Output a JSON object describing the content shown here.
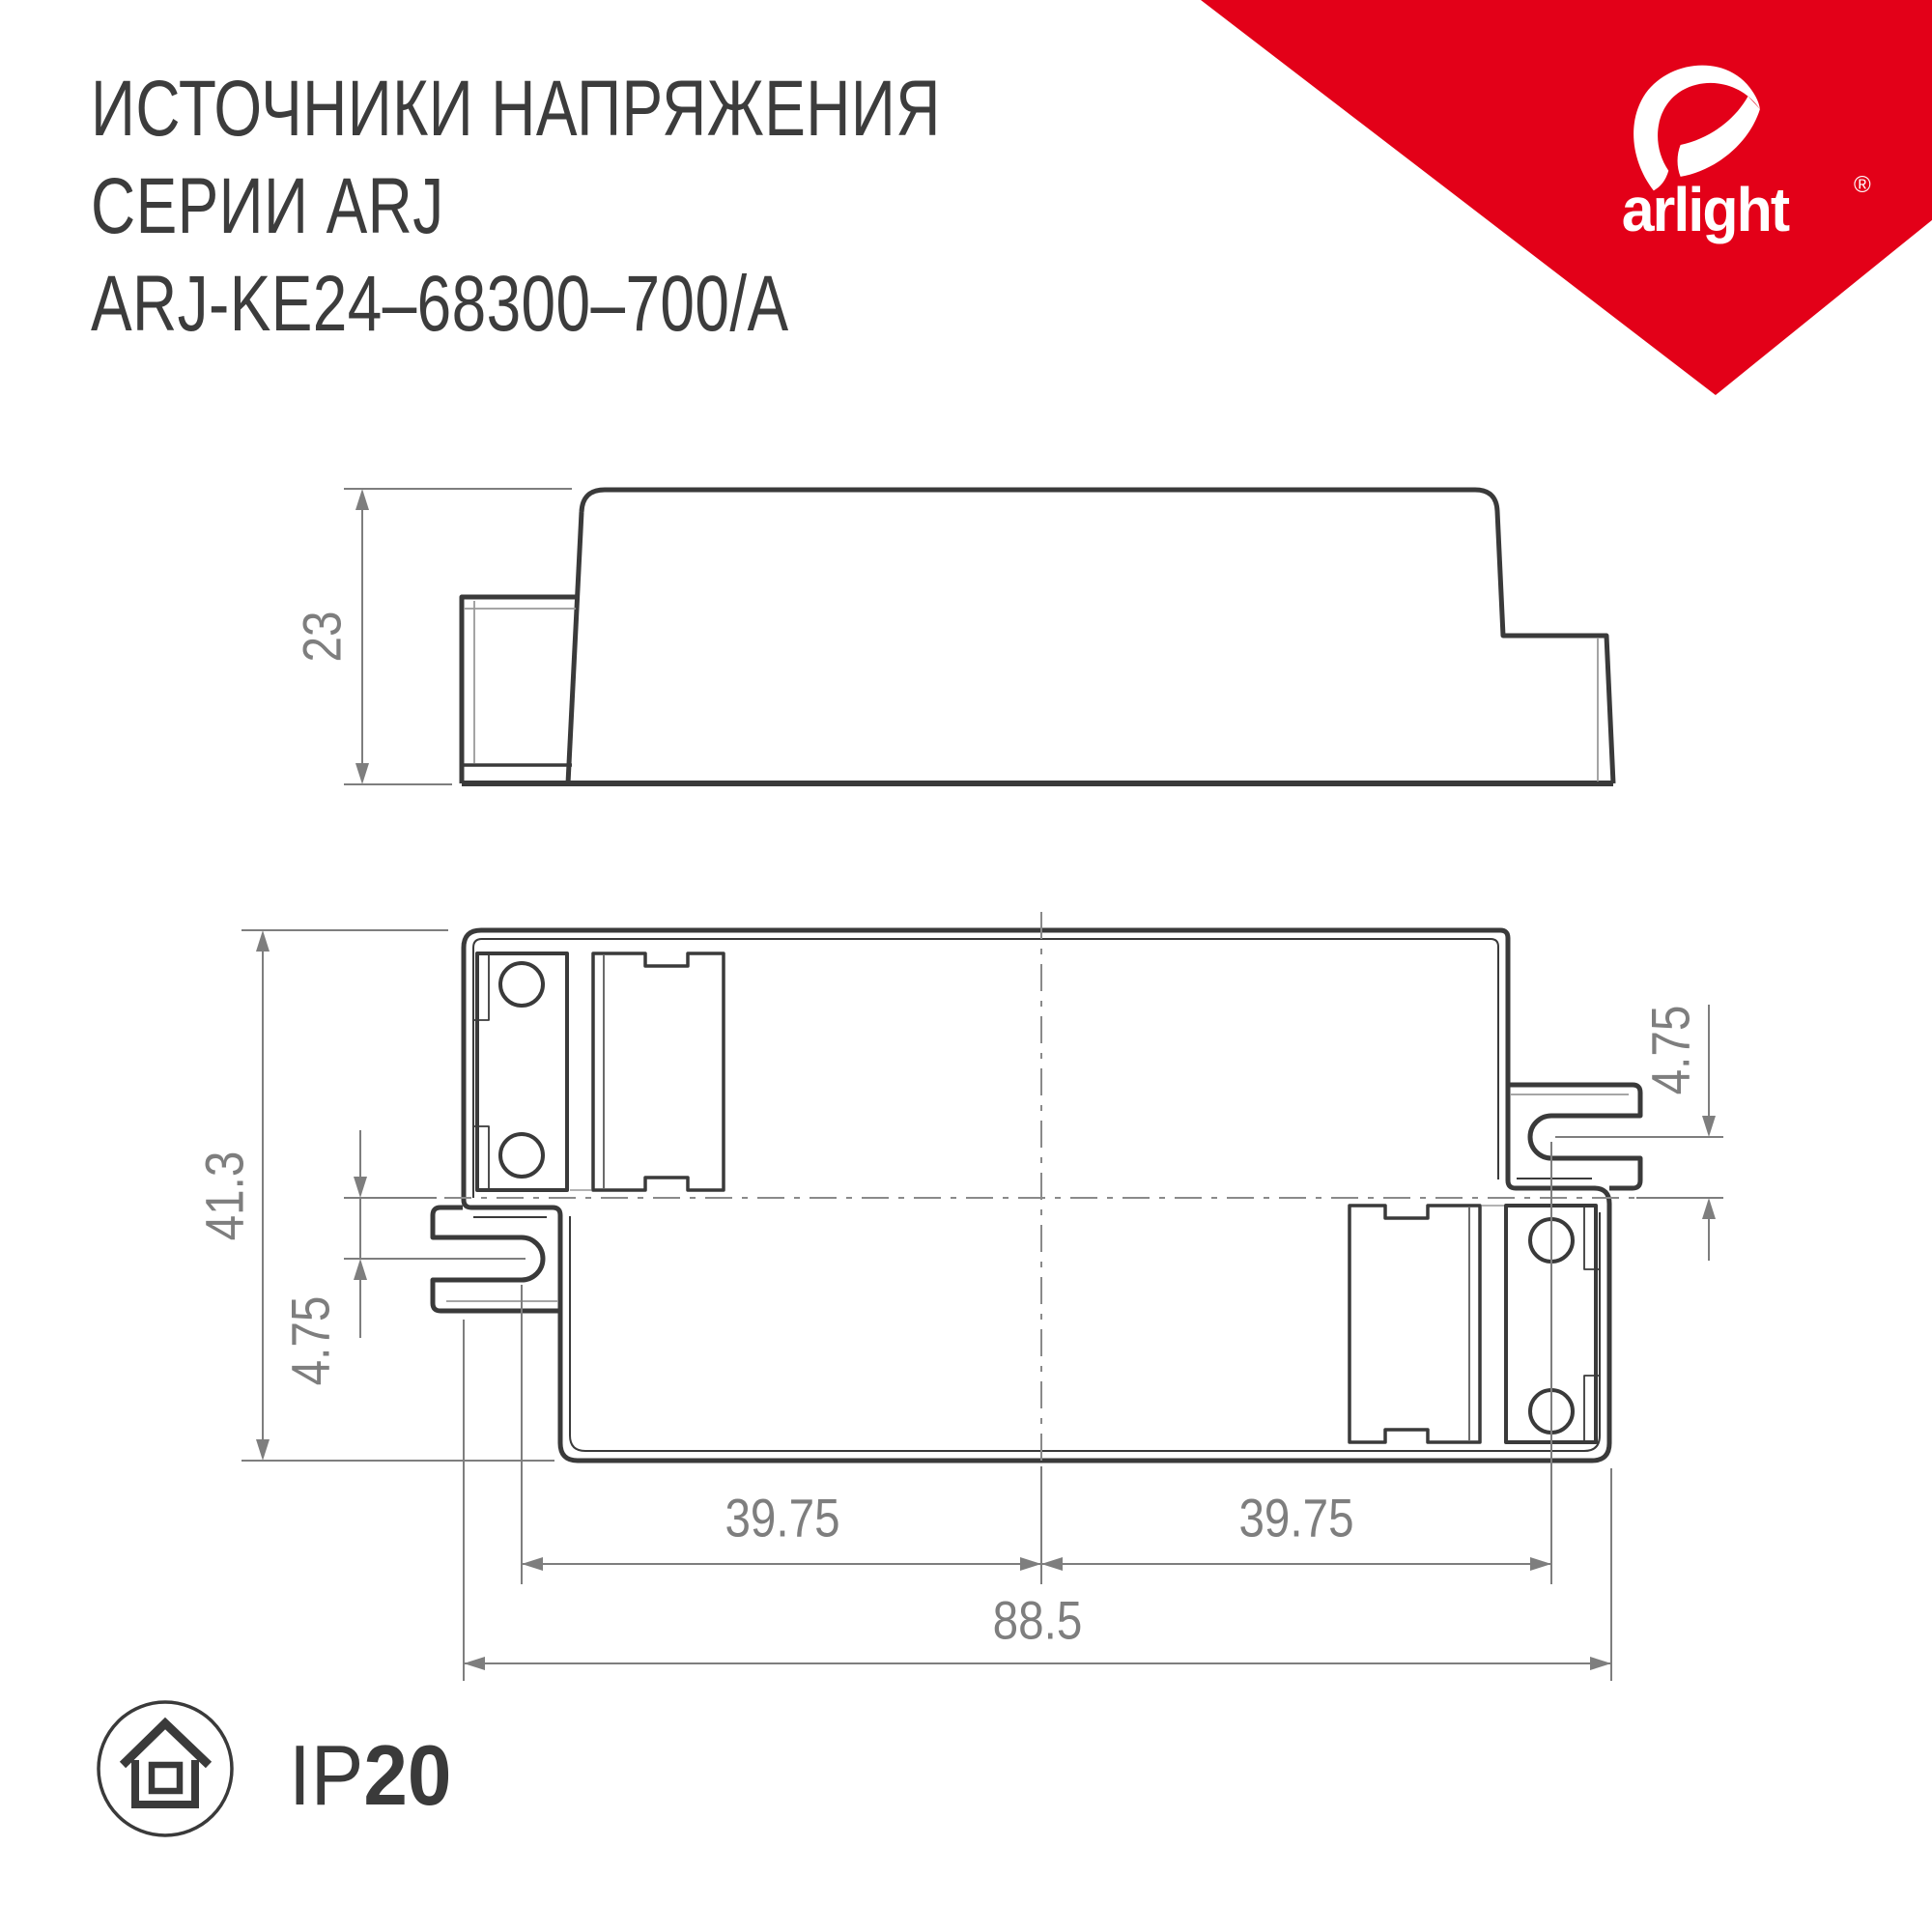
{
  "title": {
    "line1": "ИСТОЧНИКИ НАПРЯЖЕНИЯ",
    "line2": "СЕРИИ ARJ",
    "line3": "ARJ-KE24–68300–700/A"
  },
  "logo": {
    "brand": "arlight",
    "registered_mark": "®",
    "accent_color": "#e30018"
  },
  "drawing": {
    "line_color": "#3a3a3a",
    "dim_color": "#7e7e7e",
    "aux_color": "#9a9a9a",
    "side_view": {
      "height": "23"
    },
    "top_view": {
      "overall_width": "41.3",
      "slot_offset_left": "4.75",
      "slot_offset_right": "4.75",
      "slot_pitch_left": "39.75",
      "slot_pitch_right": "39.75",
      "overall_length": "88.5"
    }
  },
  "footer": {
    "protection_prefix": "IP",
    "protection_value": "20"
  }
}
